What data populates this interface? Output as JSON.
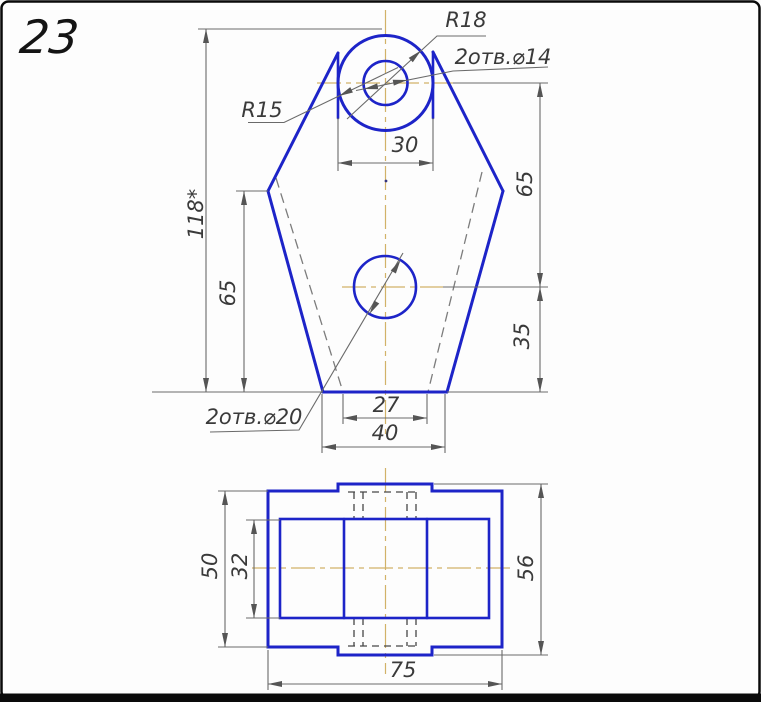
{
  "figure_number": "23",
  "front_view": {
    "labels": {
      "head_radius": "R18",
      "top_holes": "2отв.⌀14",
      "neck_radius": "R15",
      "bottom_holes": "2отв.⌀20"
    },
    "dims": {
      "head_width": "30",
      "total_height": "118*",
      "left_height": "65",
      "hole_spacing": "65",
      "bottom_hole_height": "35",
      "base_top_width": "27",
      "base_bottom_width": "40"
    }
  },
  "top_view": {
    "dims": {
      "overall_width": "75",
      "body_depth": "50",
      "inner_depth": "32",
      "overall_depth": "56"
    }
  },
  "colors": {
    "outline": "#1d24c8",
    "dimension_lines": "#6a6a6a",
    "centerline": "#d2b268",
    "hidden_line": "#7c7c7c",
    "frame": "#0a0a0a"
  }
}
